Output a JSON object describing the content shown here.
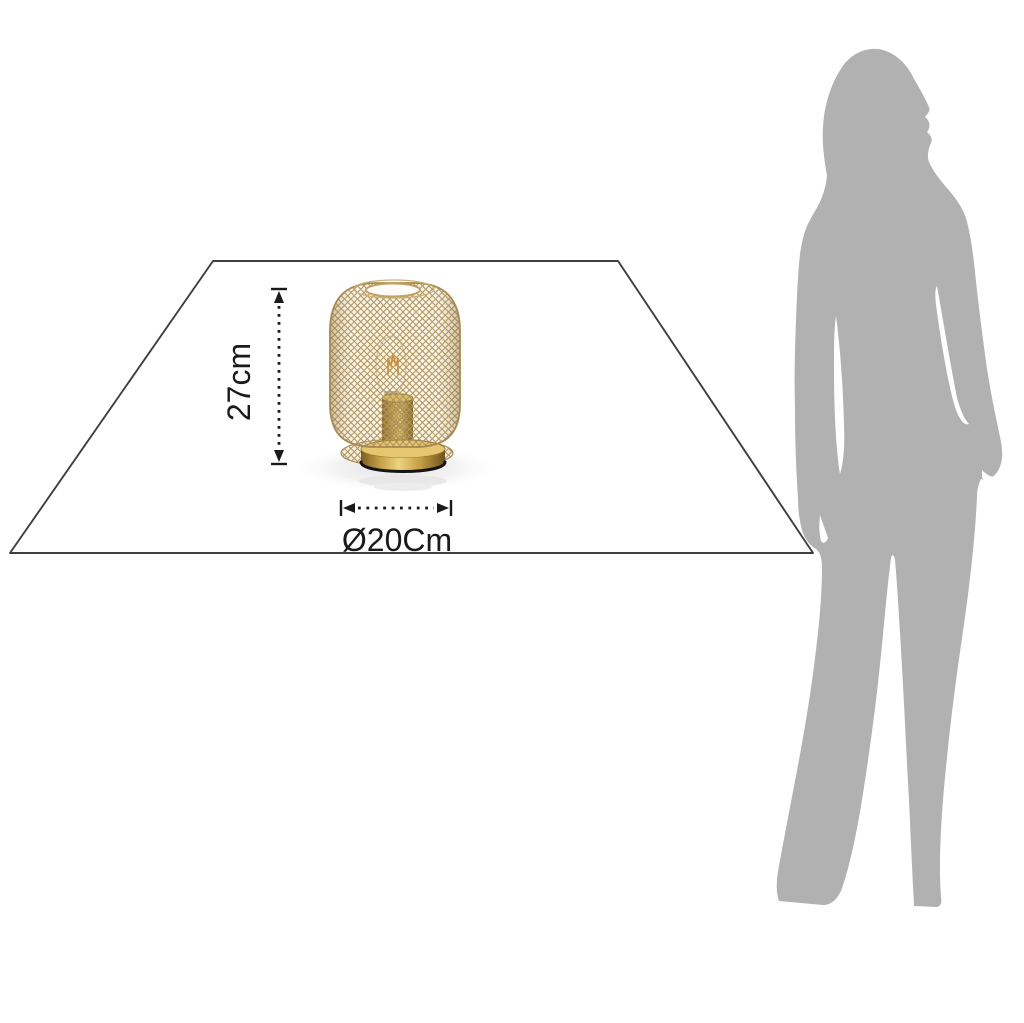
{
  "diagram": {
    "title": "lamp-size-diagram",
    "height_label": "27cm",
    "diameter_label": "Ø20Cm"
  },
  "colors": {
    "background": "#ffffff",
    "dimension": "#1a1a1a",
    "plane_line": "#3f3f3f",
    "silhouette": "#b1b1b1",
    "mesh_wire": "#b2955d",
    "brass": "#c9a54e",
    "filament": "#d98e2b"
  }
}
